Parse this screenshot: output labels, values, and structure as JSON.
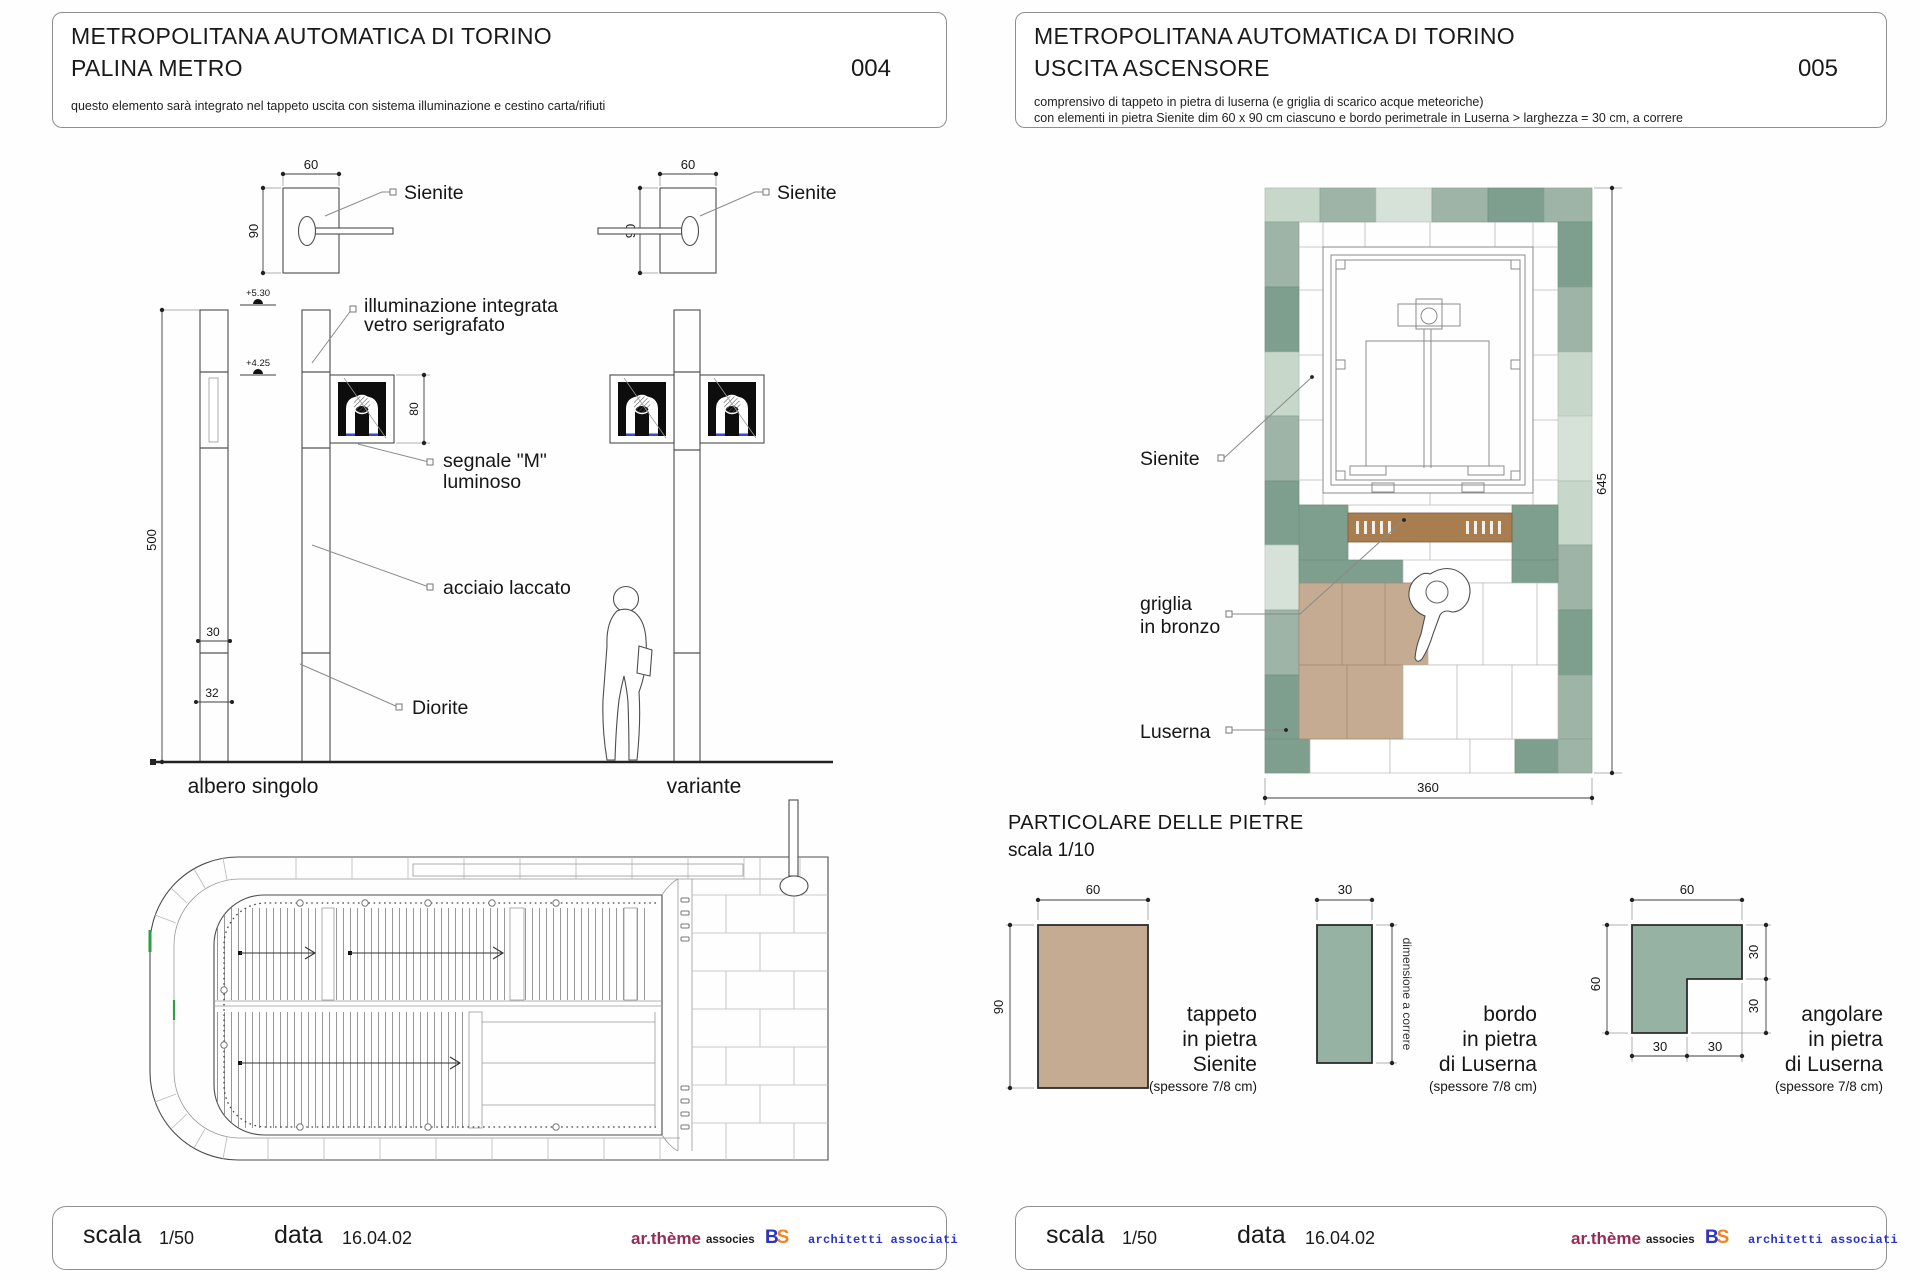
{
  "colors": {
    "luserna_sage": "#9db4a6",
    "luserna_light": "#c7d8cb",
    "luserna_teal": "#7e9f8e",
    "luserna_pale": "#d6e2d8",
    "sienite_tan": "#c5ab91",
    "bronze": "#a87e50",
    "accent_green": "#2f9e44",
    "brand_maroon": "#962c56",
    "brand_orange": "#f5831f",
    "brand_blue": "#2a35c8"
  },
  "sheet_palina": {
    "title_line1": "METROPOLITANA AUTOMATICA DI TORINO",
    "title_line2": "PALINA METRO",
    "note": "questo elemento sarà integrato nel tappeto uscita con sistema illuminazione e cestino carta/rifiuti",
    "number": "004",
    "plan_detail": {
      "dim_w": "60",
      "dim_h": "90",
      "label_sienite": "Sienite"
    },
    "elevation": {
      "dim_height": "500",
      "dim_sign": "80",
      "dim_shaft": "30",
      "dim_base": "32",
      "level_upper": "+5.30",
      "level_lower": "+4.25",
      "label_illuminazione_1": "illuminazione integrata",
      "label_illuminazione_2": "vetro serigrafato",
      "label_segnale_1": "segnale \"M\"",
      "label_segnale_2": "luminoso",
      "label_acciaio": "acciaio laccato",
      "label_diorite": "Diorite",
      "caption_left": "albero singolo",
      "caption_right": "variante"
    }
  },
  "sheet_ascensore": {
    "title_line1": "METROPOLITANA AUTOMATICA DI TORINO",
    "title_line2": "USCITA ASCENSORE",
    "note1": "comprensivo di tappeto in pietra di luserna (e griglia di scarico acque meteoriche)",
    "note2": "con elementi in pietra Sienite dim 60 x 90 cm ciascuno e bordo perimetrale in Luserna > larghezza = 30 cm, a correre",
    "number": "005",
    "plan": {
      "dim_height": "645",
      "dim_width": "360",
      "label_sienite": "Sienite",
      "label_griglia_1": "griglia",
      "label_griglia_2": "in bronzo",
      "label_luserna": "Luserna"
    },
    "particolare": {
      "heading": "PARTICOLARE DELLE PIETRE",
      "scale": "scala 1/10",
      "tappeto": {
        "dim_w": "60",
        "dim_h": "90",
        "line1": "tappeto",
        "line2": "in pietra",
        "line3": "Sienite",
        "thickness": "(spessore 7/8 cm)"
      },
      "bordo": {
        "dim_w": "30",
        "dim_note": "dimensione a correre",
        "line1": "bordo",
        "line2": "in pietra",
        "line3": "di Luserna",
        "thickness": "(spessore 7/8 cm)"
      },
      "angolare": {
        "dim_top": "60",
        "dim_left": "60",
        "dim_right_1": "30",
        "dim_right_2": "30",
        "dim_bottom_1": "30",
        "dim_bottom_2": "30",
        "line1": "angolare",
        "line2": "in pietra",
        "line3": "di Luserna",
        "thickness": "(spessore 7/8 cm)"
      }
    }
  },
  "footer": {
    "scala_label": "scala",
    "scala_value": "1/50",
    "data_label": "data",
    "data_value": "16.04.02",
    "studio1": "ar.thème",
    "studio1_suffix": "associes",
    "studio2_ls": "LS",
    "studio2_b": "B",
    "studio2_suffix": "architetti associati"
  }
}
